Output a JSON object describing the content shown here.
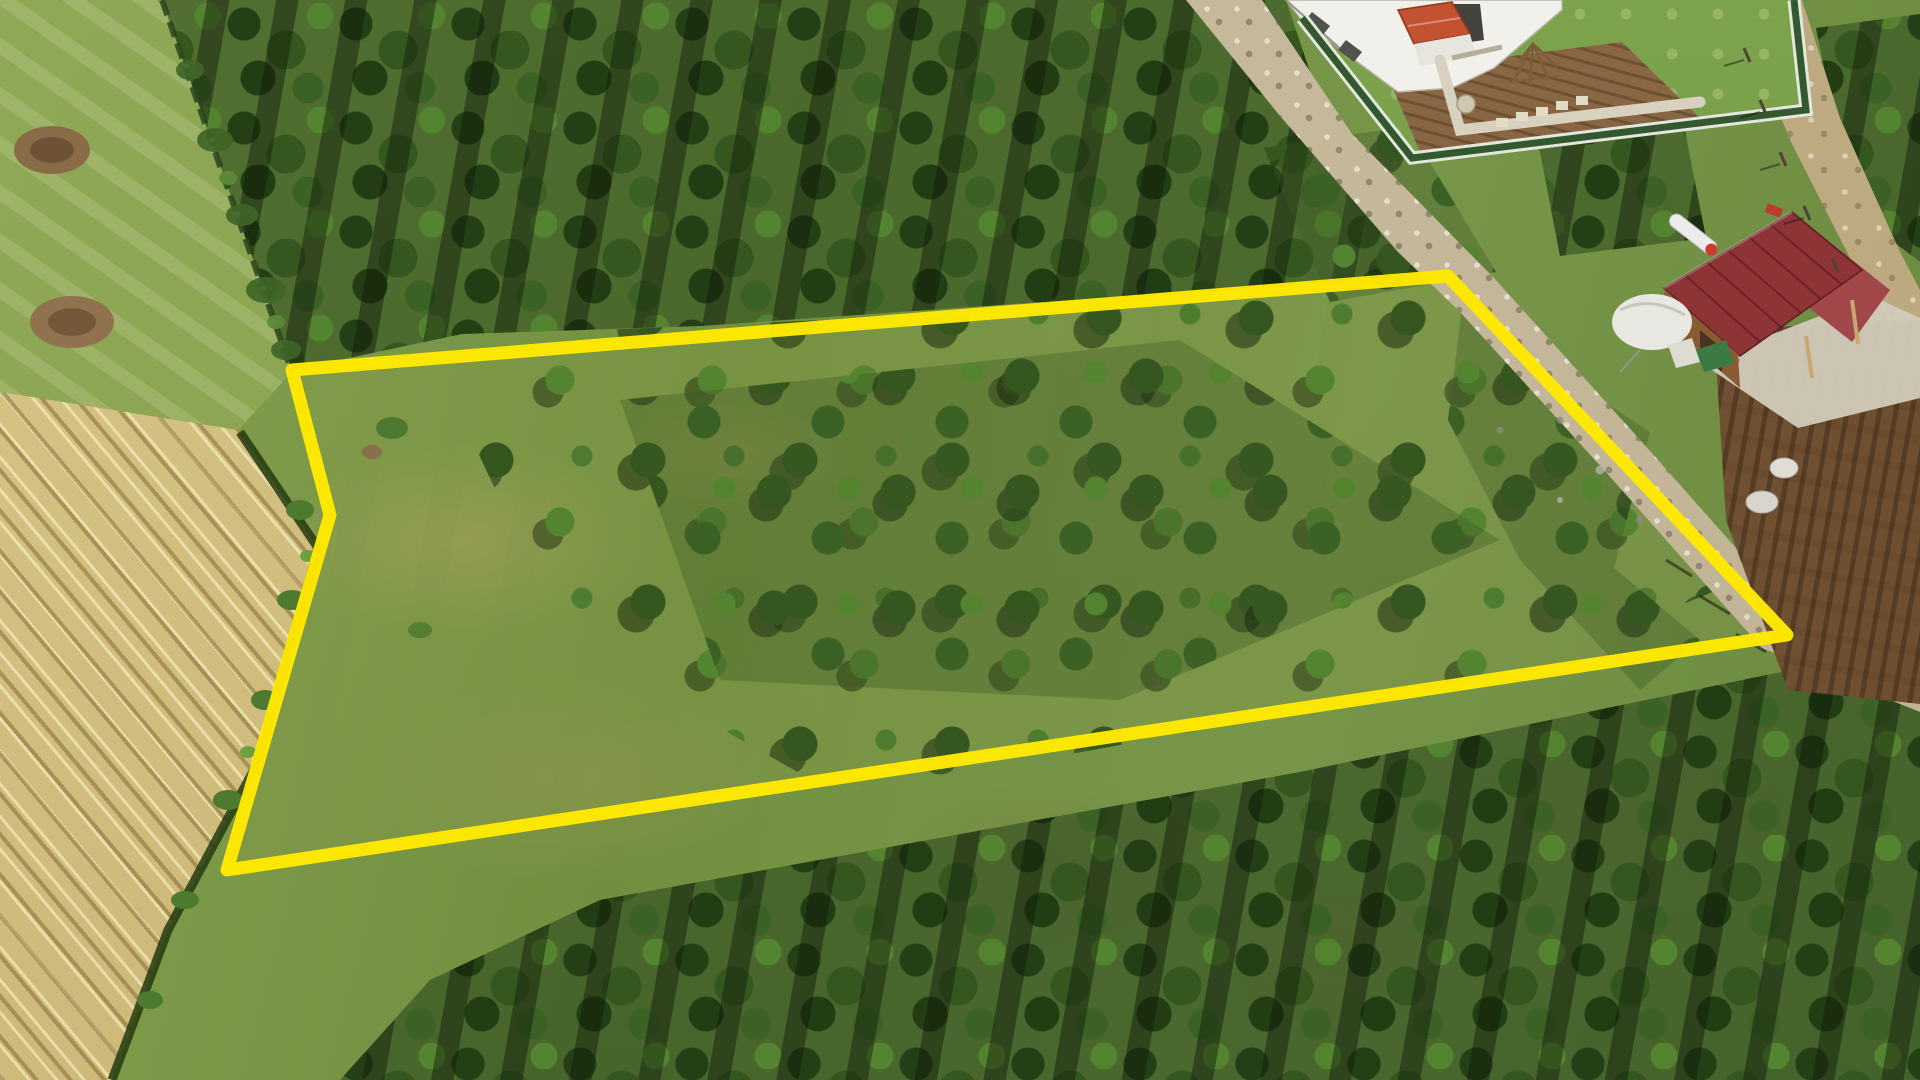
{
  "overlay": {
    "area_label": "2583 m2",
    "watermark": "emlakjet.com"
  },
  "scene": {
    "colors": {
      "boundary": "#FFE900",
      "text_fill": "#FFFFFF",
      "text_outline": "#0B0B0B",
      "text_shadow_c": "rgba(15,20,8,0.50)",
      "watermark_color": "#FFFFFF",
      "grass_base": "#71903F",
      "grass_light": "#86A251",
      "meadow_light": "#8FA855",
      "hay": "#D8C687",
      "hay_dark": "#C3AE6F",
      "canopy_dark": "#243E16",
      "canopy_mid": "#35571F",
      "canopy_mid2": "#3B6124",
      "canopy_light": "#558431",
      "road_gravel": "#CCBFA0",
      "dirt_road": "#C9B78E",
      "soil_brown": "#7C5B3A",
      "garden_soil": "#8A6844",
      "garden_green": "#7CA24C",
      "house_white": "#F2F0EB",
      "roof_red": "#8E3336",
      "roof_red_light": "#A1474A",
      "porch_red": "#C25230",
      "fence_green": "#33582F",
      "fence_wall_white": "#E3E6DC",
      "shed_brown": "#8A5A33",
      "concrete": "#D2CBBB",
      "tarp_white": "#E9E7E1",
      "tarp_green": "#3C7A44",
      "fence_dark": "#2C451C",
      "hedge_green": "#4C7A2E"
    }
  }
}
